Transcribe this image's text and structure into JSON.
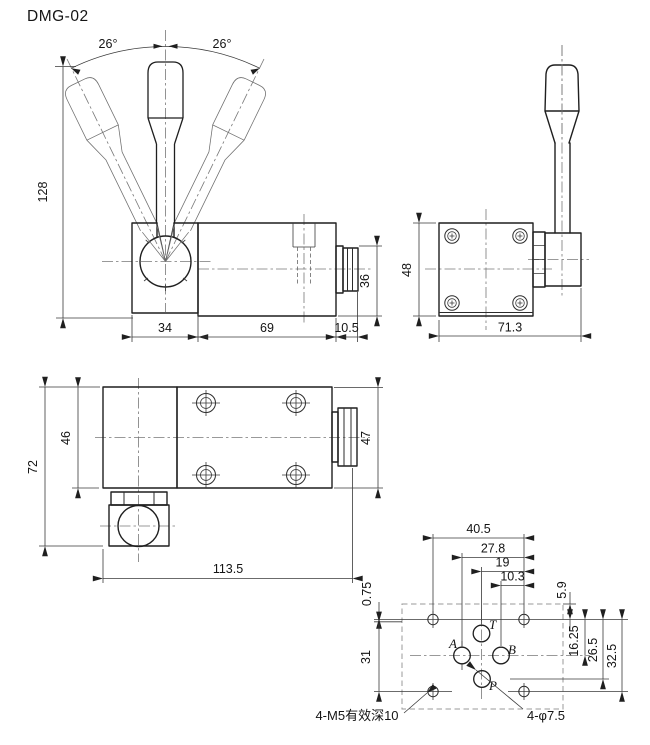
{
  "title": "DMG-02",
  "front_view": {
    "angle_left": "26°",
    "angle_right": "26°",
    "dim_height": "128",
    "dim_pivot_block": "34",
    "dim_body": "69",
    "dim_end_cap": "10.5",
    "dim_nut": "36"
  },
  "side_view": {
    "dim_height": "48",
    "dim_width": "71.3"
  },
  "top_view": {
    "dim_overall": "72",
    "dim_block": "46",
    "dim_body": "47",
    "dim_length": "113.5"
  },
  "mounting_pattern": {
    "dim_w1": "40.5",
    "dim_w2": "27.8",
    "dim_w3": "19",
    "dim_w4": "10.3",
    "dim_offset": "0.75",
    "dim_left": "31",
    "dim_top_offset": "5.9",
    "dim_r1": "16.25",
    "dim_r2": "26.5",
    "dim_r3": "32.5",
    "port_t": "T",
    "port_a": "A",
    "port_b": "B",
    "port_p": "P",
    "note_mounting_holes": "4-M5有效深10",
    "note_port_holes": "4-φ7.5"
  }
}
